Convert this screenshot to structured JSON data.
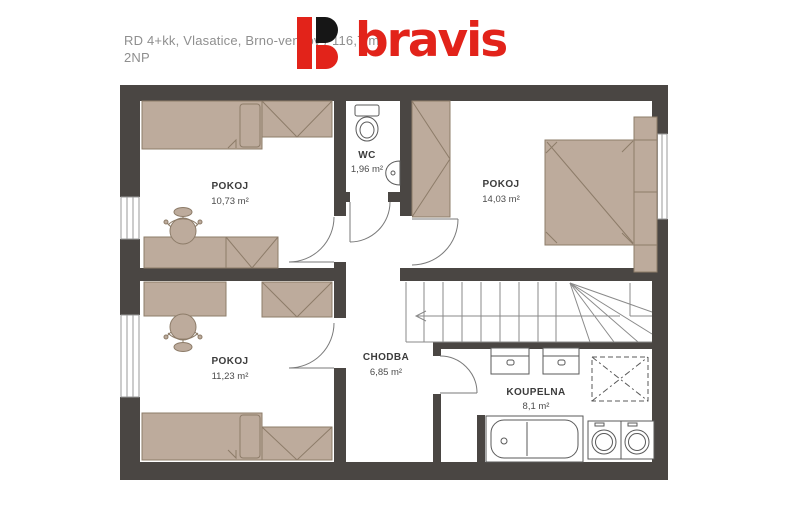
{
  "header": {
    "line1": "RD 4+kk, Vlasatice, Brno-venkov / 116,7 m²",
    "line2": "2NP"
  },
  "logo": {
    "text": "bravis",
    "red": "#e2231a",
    "black": "#161616"
  },
  "rooms": [
    {
      "name": "POKOJ",
      "area": "10,73 m²"
    },
    {
      "name": "WC",
      "area": "1,96 m²"
    },
    {
      "name": "POKOJ",
      "area": "14,03 m²"
    },
    {
      "name": "POKOJ",
      "area": "11,23 m²"
    },
    {
      "name": "CHODBA",
      "area": "6,85 m²"
    },
    {
      "name": "KOUPELNA",
      "area": "8,1 m²"
    }
  ],
  "colors": {
    "wall": "#4a4643",
    "furniture_fill": "#bdab9c",
    "furniture_stroke": "#8d7c69",
    "fixture_line": "#5a5a5a",
    "text_gray": "#8f8f8f",
    "label_dark": "#3c3c3c"
  }
}
